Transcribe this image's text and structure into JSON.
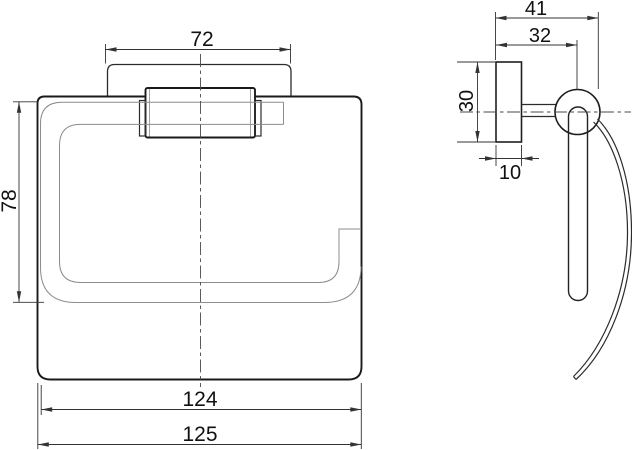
{
  "drawing": {
    "type": "technical-drawing",
    "subject": "wall-mounted paper holder, front and side orthographic views",
    "colors": {
      "background": "#ffffff",
      "main_line": "#1a1a1a",
      "light_line": "#8c8c8c",
      "dimension_line": "#333333",
      "text": "#111111"
    }
  },
  "dimensions": {
    "front": {
      "plate_width": "72",
      "roll_height": "78",
      "body_width": "124",
      "overall_width": "125"
    },
    "side": {
      "overall_depth": "41",
      "wall_to_center": "32",
      "plate_height": "30",
      "plate_thickness": "10"
    }
  }
}
